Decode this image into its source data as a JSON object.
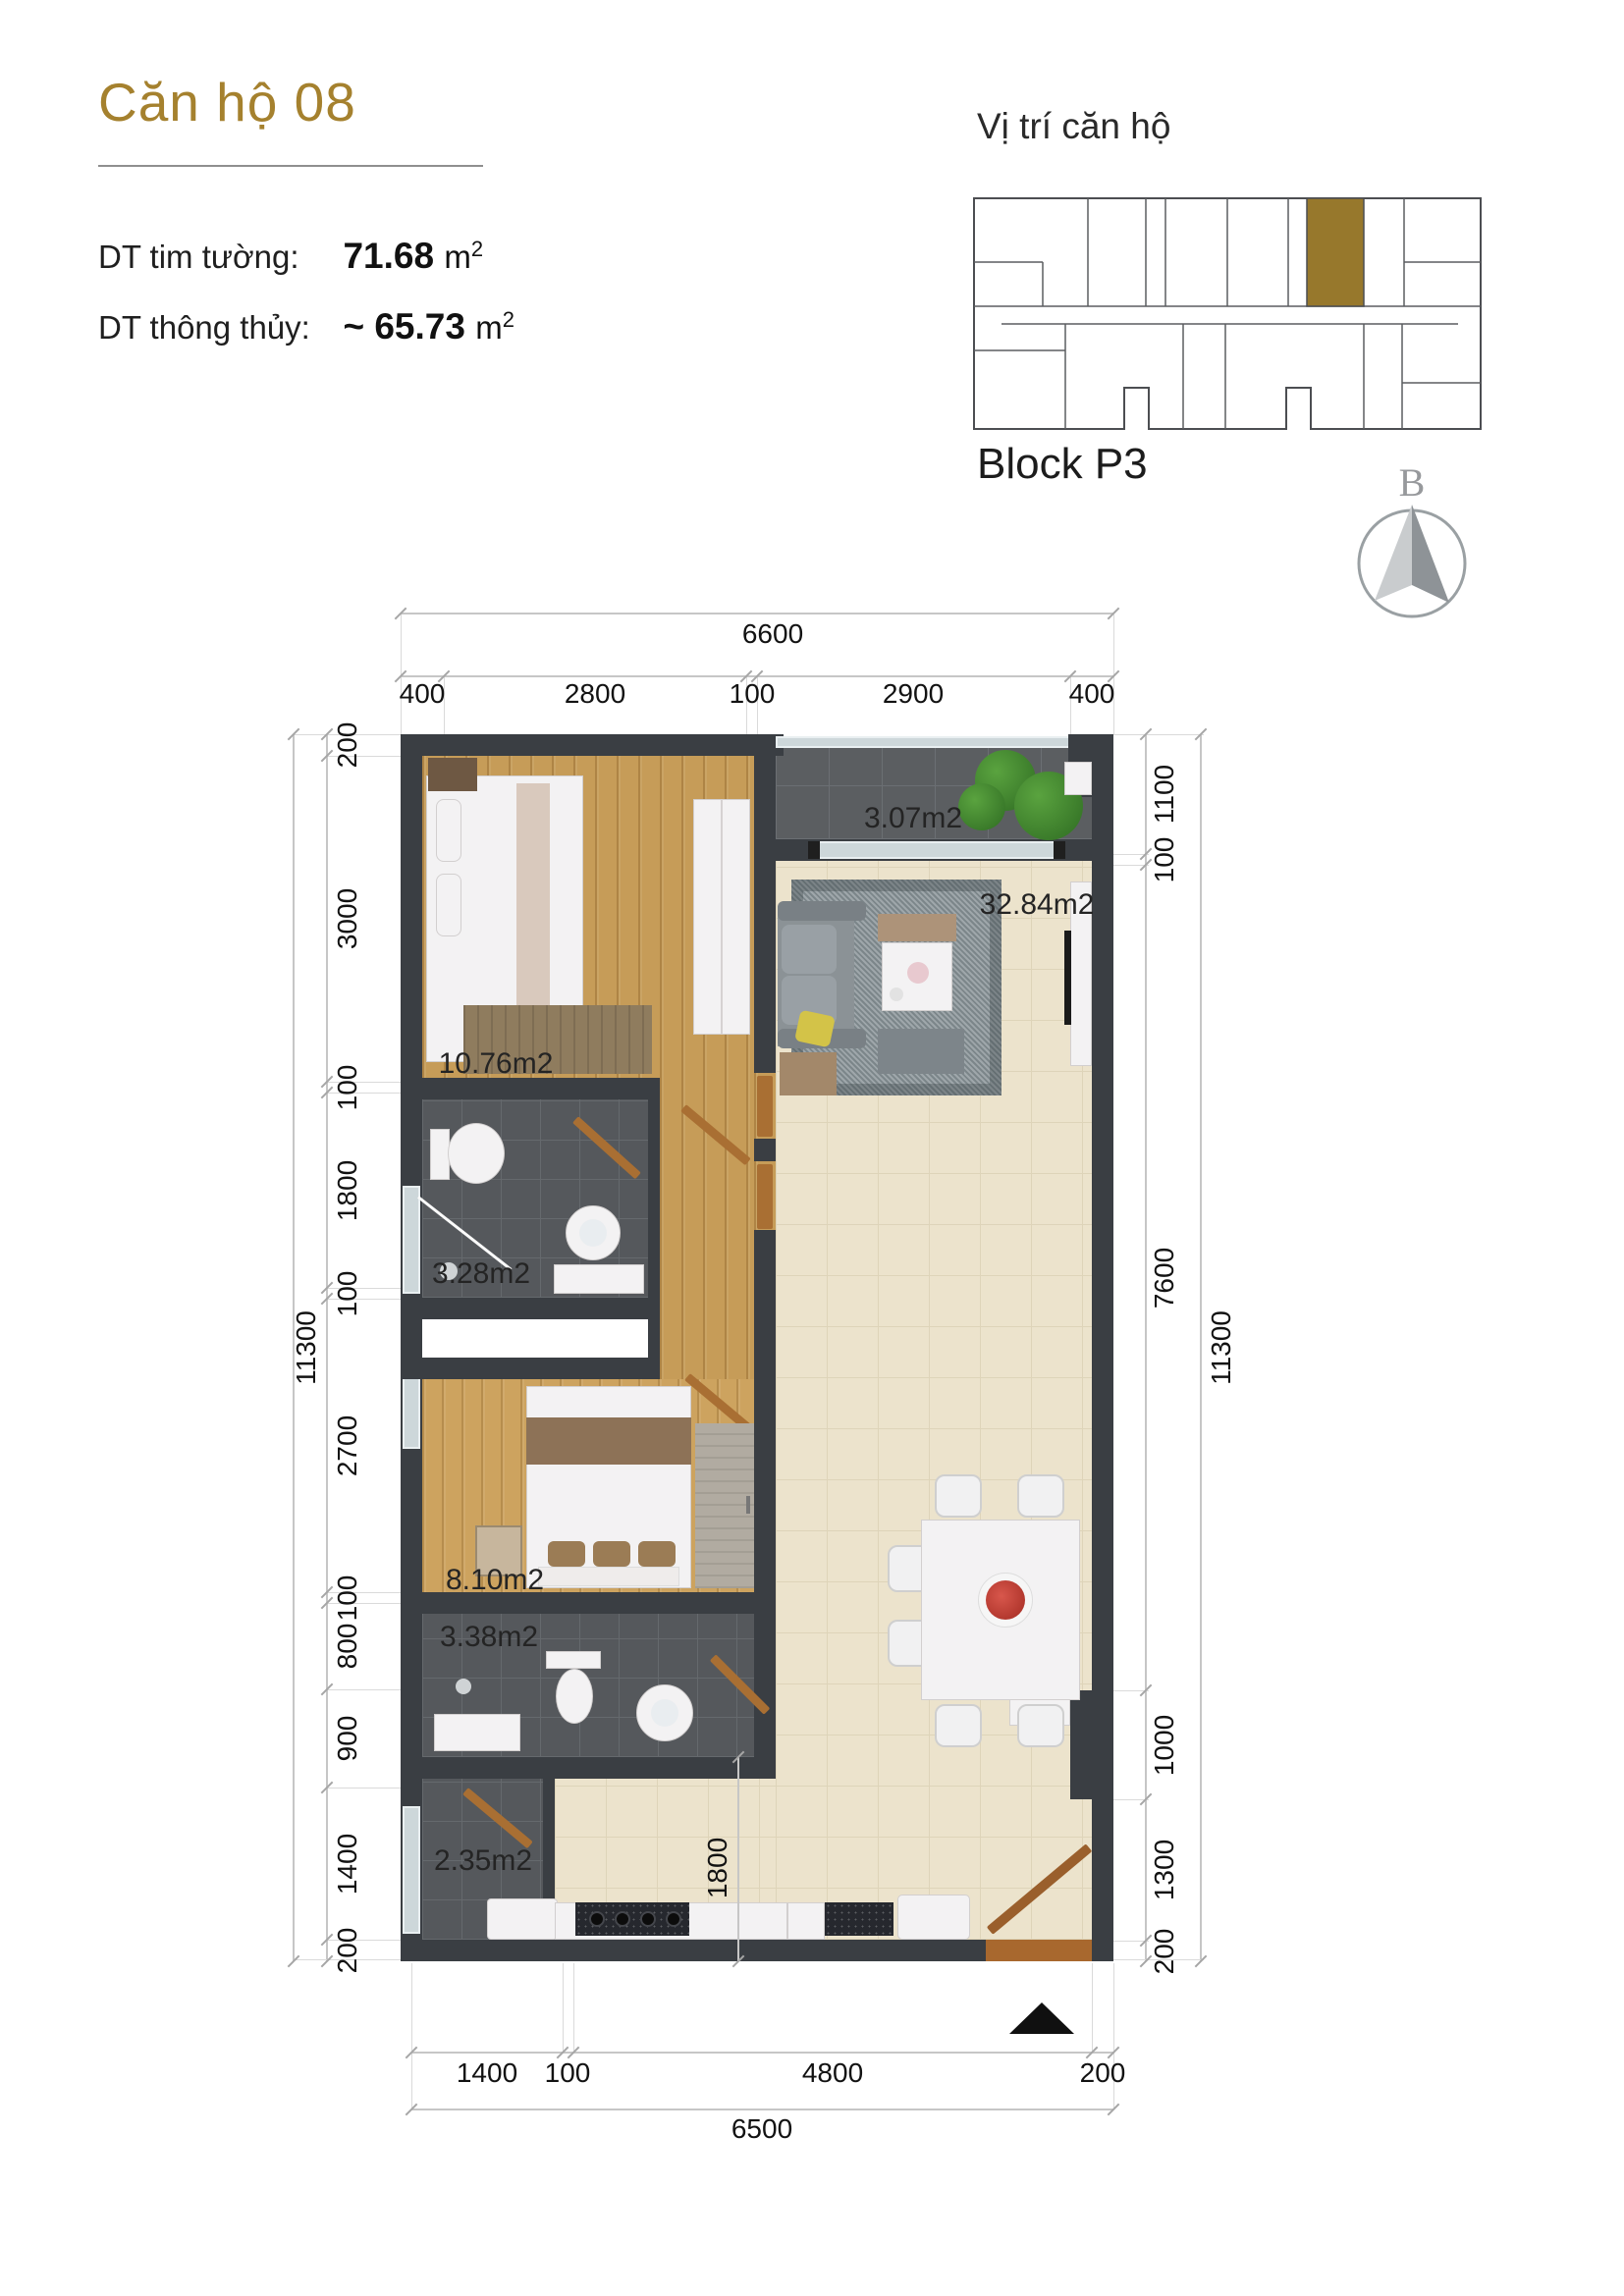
{
  "header": {
    "title": "Căn hộ 08",
    "rows": [
      {
        "label": "DT tim tường:",
        "value": "71.68",
        "unit": "m",
        "sup": "2"
      },
      {
        "label": "DT thông thủy:",
        "value": "~ 65.73",
        "unit": "m",
        "sup": "2"
      }
    ]
  },
  "location": {
    "title": "Vị trí căn hộ",
    "block_label": "Block P3"
  },
  "compass": {
    "north_label": "B"
  },
  "plan": {
    "top_total": "6600",
    "top_segments": [
      "400",
      "2800",
      "100",
      "2900",
      "400"
    ],
    "left_total": "11300",
    "left_segments": [
      "200",
      "3000",
      "100",
      "1800",
      "100",
      "2700",
      "100",
      "800",
      "900",
      "1400",
      "200"
    ],
    "right_total": "11300",
    "right_segments": [
      "1100",
      "100",
      "7600",
      "1000",
      "1300",
      "200"
    ],
    "bottom_total": "6500",
    "bottom_segments": [
      "1400",
      "100",
      "4800",
      "200"
    ],
    "interior_dim": "1800",
    "rooms": {
      "loggia_top": "3.07m2",
      "living": "32.84m2",
      "bedroom1": "10.76m2",
      "wc1": "3.28m2",
      "bedroom2": "8.10m2",
      "wc2": "3.38m2",
      "loggia_bottom": "2.35m2"
    }
  },
  "colors": {
    "accent_gold": "#a5812e",
    "unit_highlight": "#97782c",
    "wall": "#3a3e43"
  }
}
